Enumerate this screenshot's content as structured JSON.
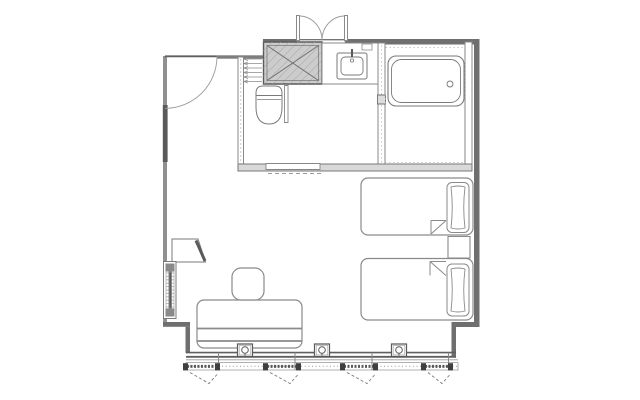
{
  "document": {
    "type": "architectural-floor-plan",
    "subject": "hotel guest room plan",
    "background": "#ffffff"
  },
  "palette": {
    "outer_wall": "#6f6f6f",
    "wall_dark": "#5a5a5a",
    "wall_light": "#909090",
    "partition": "#888888",
    "fixture": "#7a7a7a",
    "furniture": "#8a8a8a",
    "light_line": "#9a9a9a",
    "dash": "#999999",
    "shaft_fill": "#cccccc",
    "band_fill": "#d9d9d9",
    "curtain_bar": "#5a5a5a",
    "curtain_block": "#3f3f3f"
  },
  "rooms": [
    "entry",
    "bathroom",
    "bedroom"
  ],
  "fixture_names": [
    "entry-double-door",
    "closet-door",
    "pipe-shaft",
    "vanity-sink",
    "bathtub",
    "toilet",
    "sliding-door",
    "bed-1",
    "bed-2",
    "pillow",
    "nightstand",
    "sofa",
    "ottoman",
    "tv-corner-unit",
    "wall-panel",
    "floor-outlet",
    "window-curtains"
  ],
  "window_wall": {
    "wall_x": [
      186,
      456
    ],
    "band_x": [
      186,
      458
    ],
    "band_y": [
      362.5,
      370
    ],
    "mullions_x": [
      218.5,
      295,
      372,
      448.5
    ],
    "outlets_x": [
      245,
      322,
      399
    ],
    "outlet_y": 350,
    "curtain_rods": [
      [
        184,
        219
      ],
      [
        264,
        300
      ],
      [
        341,
        377
      ],
      [
        422,
        452
      ]
    ],
    "rod_y": 366.4,
    "swag_depth": 11
  },
  "louvers": {
    "x1": 244,
    "x2": 262,
    "ys": [
      59,
      63.5,
      68,
      72.5,
      77,
      81.5
    ]
  }
}
